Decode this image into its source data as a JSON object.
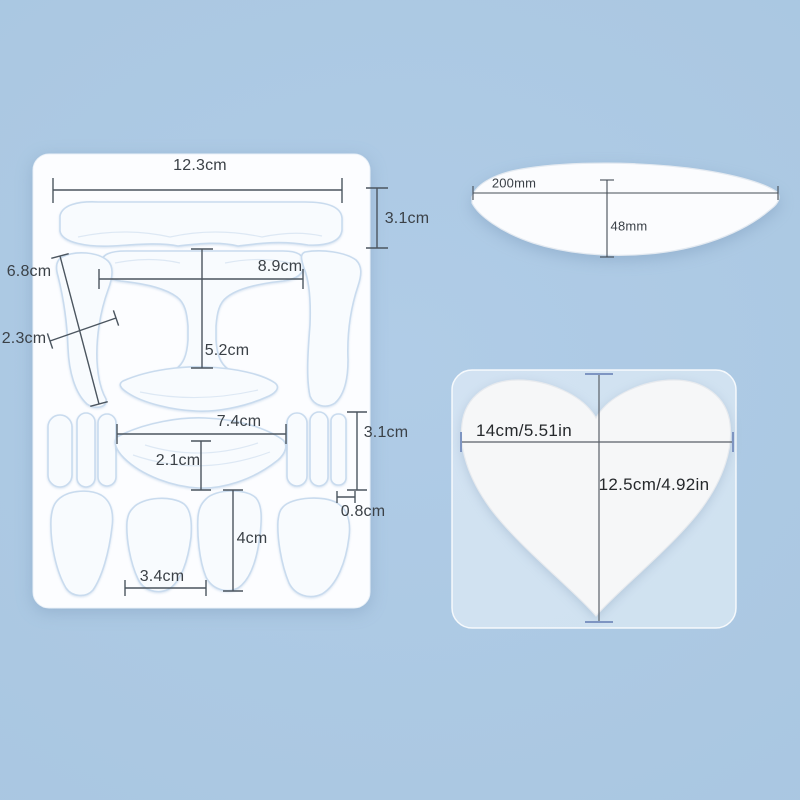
{
  "colors": {
    "background": "#abc8e2",
    "sheet_fill": "#fcfdff",
    "patch_outline": "#c9dbee",
    "dimension_line": "#4b555f",
    "label_text": "#3b4147",
    "heart_tick": "#7e95c2"
  },
  "face_patch_sheet": {
    "dim_labels": {
      "forehead_width": "12.3cm",
      "forehead_height": "3.1cm",
      "side_band_length": "6.8cm",
      "side_band_width": "2.3cm",
      "tzone_width": "8.9cm",
      "tzone_height": "5.2cm",
      "chin_width": "7.4cm",
      "chin_height": "2.1cm",
      "eye_strip_height": "3.1cm",
      "eye_strip_width": "0.8cm",
      "cheek_height": "4cm",
      "cheek_width": "3.4cm"
    }
  },
  "neck_patch": {
    "width": "200mm",
    "depth": "48mm"
  },
  "chest_patch": {
    "width": "14cm/5.51in",
    "height": "12.5cm/4.92in"
  }
}
